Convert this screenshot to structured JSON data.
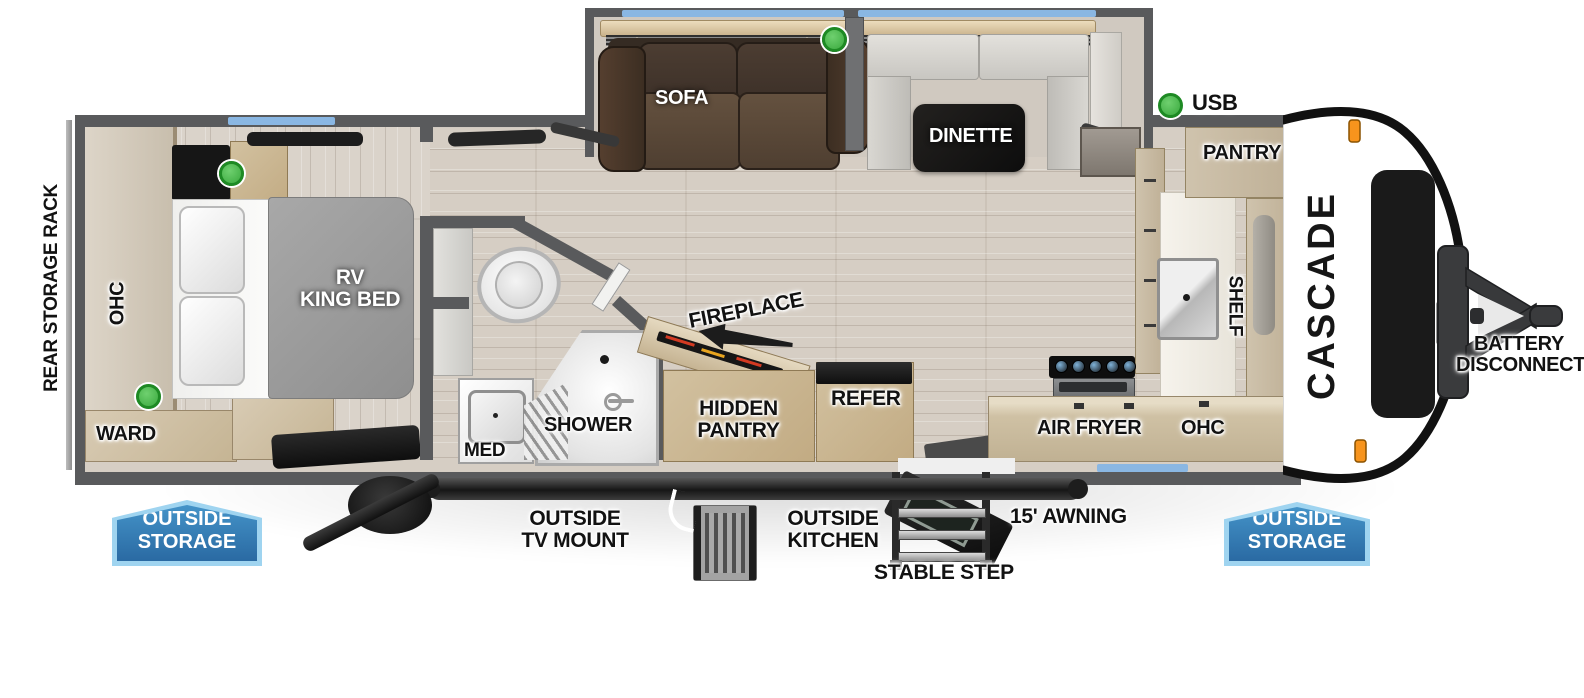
{
  "brand_logo": "CASCADE",
  "exterior": {
    "usb_label": "USB",
    "rear_storage_rack": "REAR STORAGE RACK",
    "battery_disconnect_line1": "BATTERY",
    "battery_disconnect_line2": "DISCONNECT",
    "outside_storage_left_line1": "OUTSIDE",
    "outside_storage_left_line2": "STORAGE",
    "outside_storage_right_line1": "OUTSIDE",
    "outside_storage_right_line2": "STORAGE",
    "outside_tv_mount_line1": "OUTSIDE",
    "outside_tv_mount_line2": "TV MOUNT",
    "outside_kitchen_line1": "OUTSIDE",
    "outside_kitchen_line2": "KITCHEN",
    "stable_step": "STABLE STEP",
    "awning": "15' AWNING"
  },
  "bedroom": {
    "ohc": "OHC",
    "ward": "WARD",
    "bed_line1": "RV",
    "bed_line2": "KING BED"
  },
  "bathroom": {
    "med": "MED",
    "shower": "SHOWER"
  },
  "living": {
    "sofa": "SOFA",
    "dinette": "DINETTE",
    "fireplace": "FIREPLACE",
    "hidden_pantry_line1": "HIDDEN",
    "hidden_pantry_line2": "PANTRY",
    "refer": "REFER"
  },
  "kitchen": {
    "pantry": "PANTRY",
    "shelf": "SHELF",
    "air_fryer": "AIR FRYER",
    "ohc": "OHC"
  },
  "colors": {
    "wall": "#595a5c",
    "window_blue": "#8ab7e3",
    "badge_blue": "#2f7cb5",
    "badge_border": "#9fd4f0",
    "usb_green": "#45b649",
    "marker_orange": "#f7941d"
  }
}
